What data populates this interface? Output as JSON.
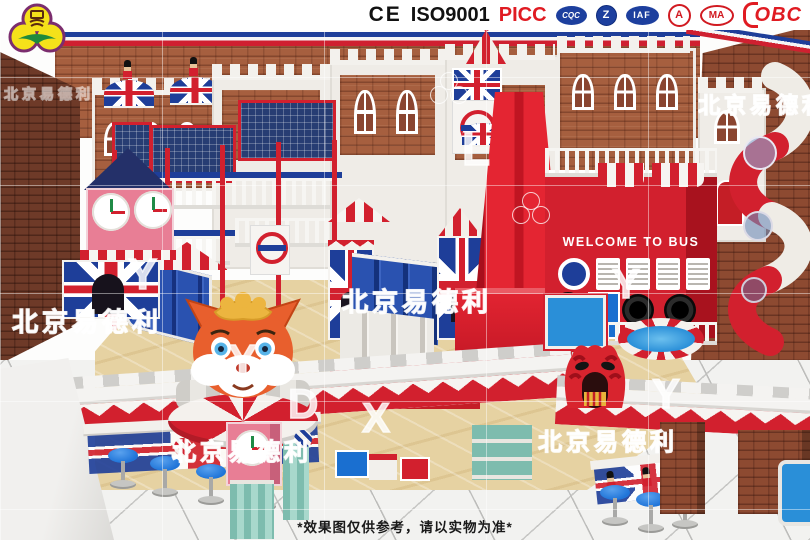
{
  "header": {
    "logo": {
      "company": "北京易德利",
      "glyph": "易"
    },
    "certs": {
      "ce": "CE",
      "iso": "ISO9001",
      "picc": "PICC",
      "badge_cqc": "CQC",
      "badge_z": "Z",
      "badge_iaf": "IAF",
      "badge_a": "A",
      "badge_ma": "MA",
      "obc": "OBC"
    }
  },
  "scene": {
    "bus_sign": "WELCOME TO BUS",
    "watermark": "北京易德利",
    "letters": {
      "l1": "L",
      "y1": "Y",
      "y2": "Y",
      "d1": "D",
      "x1": "X",
      "y3": "Y",
      "y4": "Y"
    }
  },
  "footer": {
    "disclaimer": "*效果图仅供参考，请以实物为准*"
  },
  "colors": {
    "theme_red": "#d2202e",
    "theme_blue": "#1e3e99",
    "theme_pink": "#e87e95",
    "logo_yellow": "#f5e11a",
    "picc_red": "#e01b22"
  }
}
